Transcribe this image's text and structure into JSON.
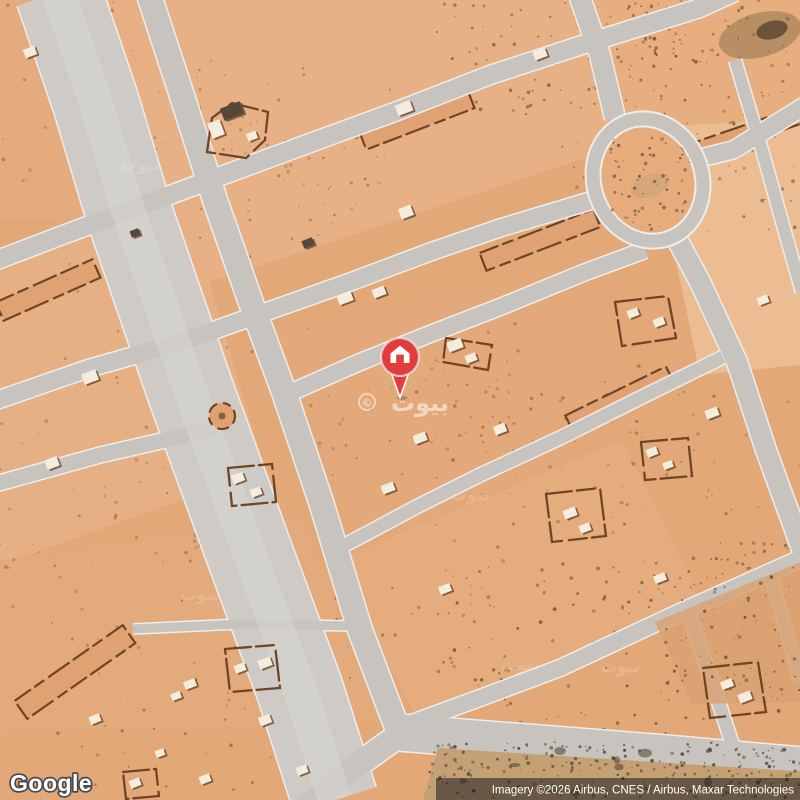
{
  "page": {
    "kind": "satellite-map-view"
  },
  "branding": {
    "logo_text": "Google"
  },
  "attribution": {
    "text": "Imagery ©2026 Airbus, CNES / Airbus, Maxar Technologies"
  },
  "watermark": {
    "text": "بيوت",
    "copyright": "©"
  },
  "marker": {
    "name": "property-location-pin",
    "icon": "house",
    "color": "#e23c3c",
    "border": "#ffffff"
  },
  "map_features": {
    "roundabout": "traffic-circle-upper-right",
    "terrain": "desert-residential-subdivision"
  },
  "colors": {
    "sand": "#e2a878",
    "sand_light": "#ecbd92",
    "road": "#c7c4bf",
    "road_casing": "#efede9",
    "wall_brown": "#6f4526",
    "building_white": "#f4ecdc",
    "rough_ground": "#c29d74",
    "pin_red": "#e23c3c",
    "attribution_bg": "rgba(30,30,30,0.55)"
  }
}
